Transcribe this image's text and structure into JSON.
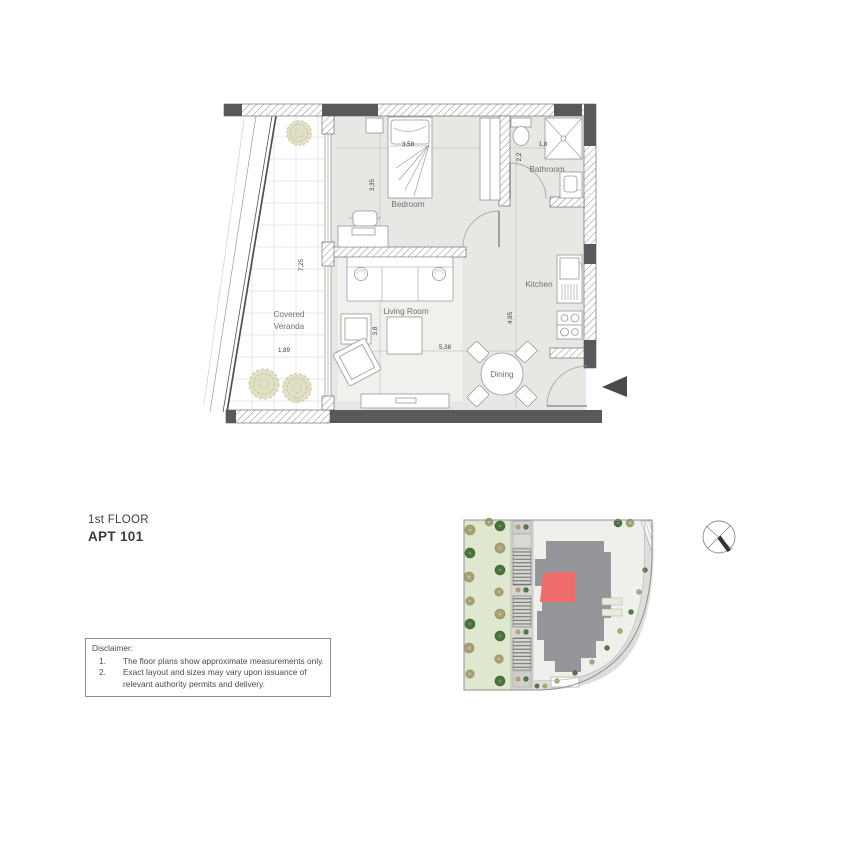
{
  "header": {
    "floor_label": "1st FLOOR",
    "apt_label": "APT 101"
  },
  "disclaimer": {
    "title": "Disclaimer:",
    "items": [
      {
        "num": "1.",
        "text": "The floor plans show approximate measurements only."
      },
      {
        "num": "2.",
        "text": "Exact layout and sizes may vary upon issuance of relevant authority permits and delivery."
      }
    ]
  },
  "floor_plan": {
    "rooms": {
      "bedroom": "Bedroom",
      "bathroom": "Bathroom",
      "kitchen": "Kitchen",
      "living_room": "Living Room",
      "dining": "Dining",
      "covered_veranda_1": "Covered",
      "covered_veranda_2": "Veranda"
    },
    "dimensions": {
      "bedroom_width": "3,58",
      "bedroom_depth": "3,35",
      "bathroom_width": "1,8",
      "bathroom_depth": "2,2",
      "veranda_length": "7,25",
      "veranda_width": "1,89",
      "living_depth": "3,8",
      "living_width": "5,38",
      "kitchen_length": "4,95"
    }
  },
  "colors": {
    "unit_highlight": "#f16d6d",
    "building": "#95959a",
    "lawn": "#dfe8cf",
    "interior_floor": "#e8e7e4",
    "wall_dark": "#59595b"
  }
}
